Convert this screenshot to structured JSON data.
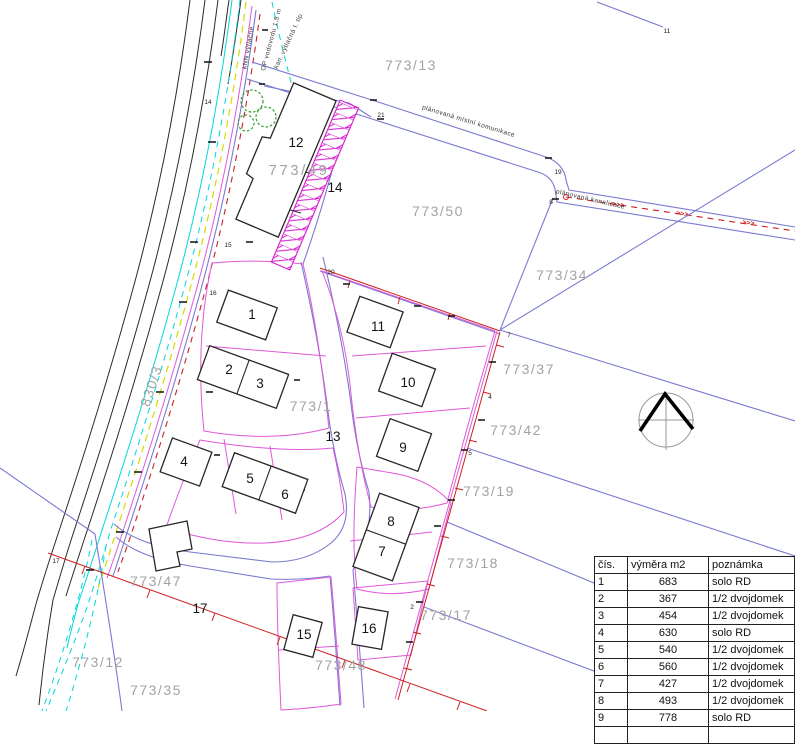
{
  "map": {
    "parcel_labels": [
      {
        "id": "773-13",
        "text": "773/13"
      },
      {
        "id": "773-49",
        "text": "773/49"
      },
      {
        "id": "773-50",
        "text": "773/50"
      },
      {
        "id": "773-34",
        "text": "773/34"
      },
      {
        "id": "773-37",
        "text": "773/37"
      },
      {
        "id": "773-42",
        "text": "773/42"
      },
      {
        "id": "773-19",
        "text": "773/19"
      },
      {
        "id": "773-18",
        "text": "773/18"
      },
      {
        "id": "773-17",
        "text": "773/17"
      },
      {
        "id": "773-48",
        "text": "773/48"
      },
      {
        "id": "773-47",
        "text": "773/47"
      },
      {
        "id": "773-12",
        "text": "773/12"
      },
      {
        "id": "773-35",
        "text": "773/35"
      },
      {
        "id": "773-1",
        "text": "773/1"
      },
      {
        "id": "830-3",
        "text": "830/3"
      }
    ],
    "site_numbers": [
      {
        "text": "1"
      },
      {
        "text": "2"
      },
      {
        "text": "3"
      },
      {
        "text": "4"
      },
      {
        "text": "5"
      },
      {
        "text": "6"
      },
      {
        "text": "7"
      },
      {
        "text": "8"
      },
      {
        "text": "9"
      },
      {
        "text": "10"
      },
      {
        "text": "11"
      },
      {
        "text": "12"
      },
      {
        "text": "13"
      },
      {
        "text": "14"
      },
      {
        "text": "15"
      },
      {
        "text": "16"
      },
      {
        "text": "17"
      }
    ],
    "point_numbers": [
      {
        "text": "21"
      },
      {
        "text": "19"
      },
      {
        "text": "8"
      },
      {
        "text": "11"
      },
      {
        "text": "15"
      },
      {
        "text": "16"
      },
      {
        "text": "14"
      },
      {
        "text": "17"
      },
      {
        "text": "20"
      },
      {
        "text": "4"
      },
      {
        "text": "5"
      },
      {
        "text": "7"
      },
      {
        "text": "2"
      }
    ],
    "utility_labels": [
      {
        "text": "kNN výtlačné"
      },
      {
        "text": "OP vodovodu 1,5 m"
      },
      {
        "text": "kan. výtlačná I. tlp"
      }
    ],
    "road_labels": [
      {
        "text": "plánovaná místní komunikace"
      },
      {
        "text": "plánovaná kanalizace"
      }
    ],
    "flow_arrows": ">>>",
    "colors": {
      "cadastral_blue": "#7a7ad2",
      "plot_pink": "#e058d8",
      "hatch_magenta": "#d81fd0",
      "water_cyan": "#00d8d8",
      "utility_yellow": "#d8d800",
      "planned_red": "#cc2020",
      "label_gray": "#a3a3a3",
      "tree_green": "#2f9e2f"
    }
  },
  "legend_table": {
    "headers": [
      "čís.",
      "výměra m2",
      "poznámka"
    ],
    "rows": [
      [
        "1",
        "683",
        "solo RD"
      ],
      [
        "2",
        "367",
        "1/2 dvojdomek"
      ],
      [
        "3",
        "454",
        "1/2 dvojdomek"
      ],
      [
        "4",
        "630",
        "solo RD"
      ],
      [
        "5",
        "540",
        "1/2 dvojdomek"
      ],
      [
        "6",
        "560",
        "1/2 dvojdomek"
      ],
      [
        "7",
        "427",
        "1/2 dvojdomek"
      ],
      [
        "8",
        "493",
        "1/2 dvojdomek"
      ],
      [
        "9",
        "778",
        "solo RD"
      ]
    ]
  }
}
